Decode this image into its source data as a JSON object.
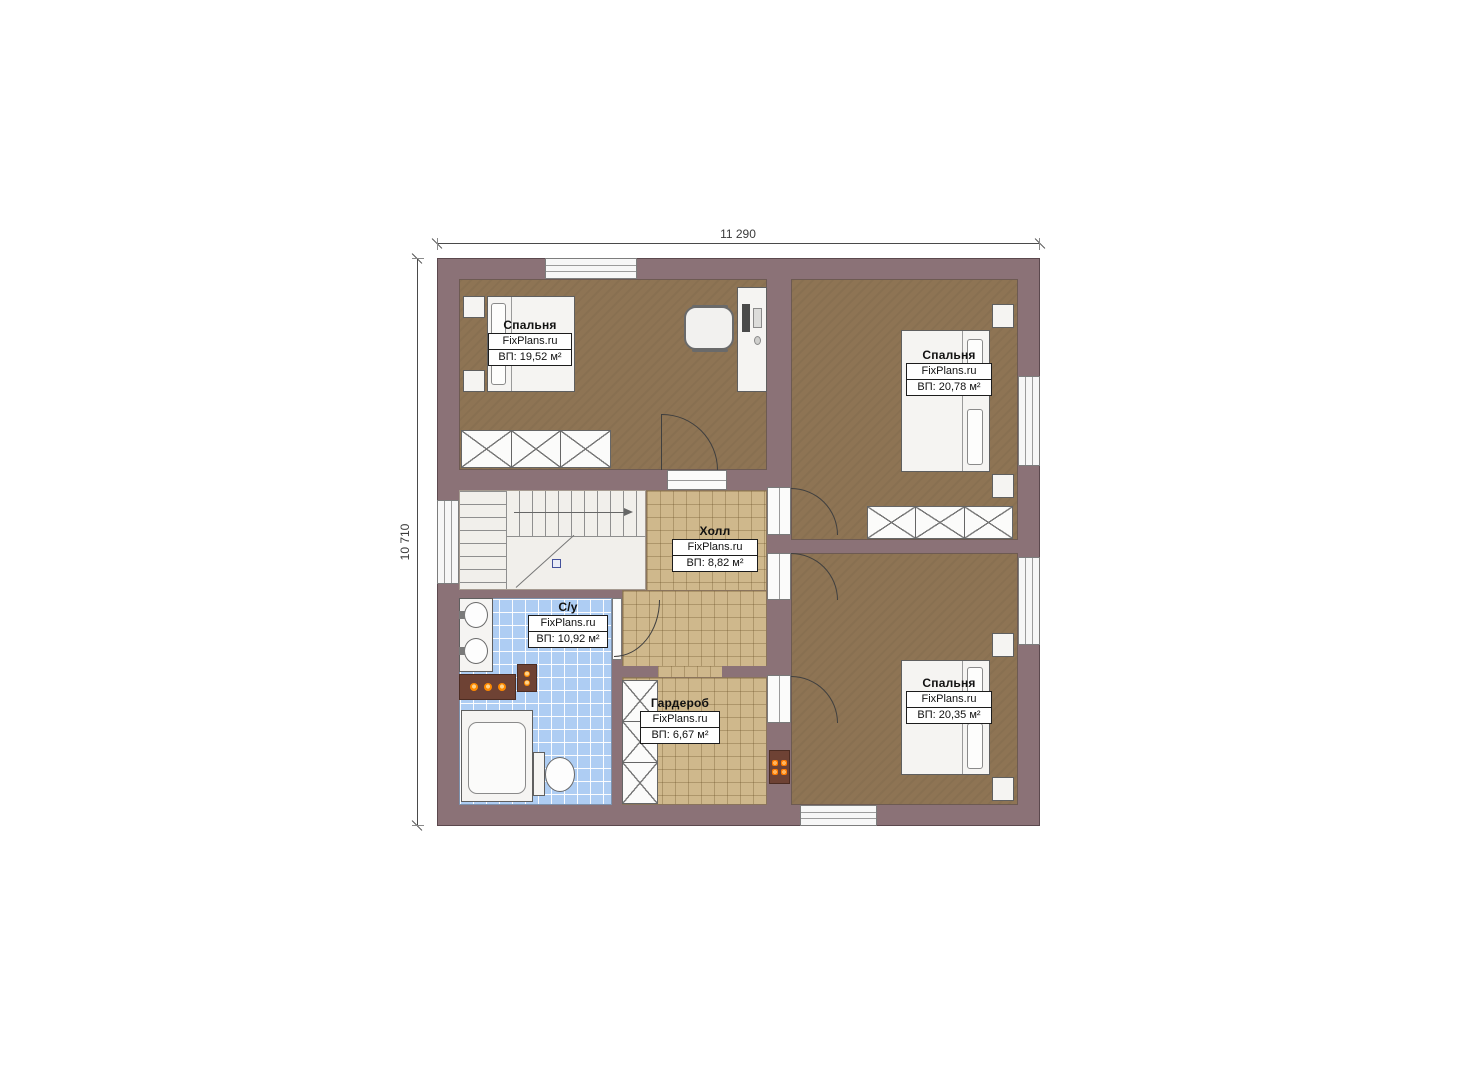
{
  "plan": {
    "type": "floor-plan",
    "language": "ru",
    "brand": "FixPlans.ru"
  },
  "dimensions": {
    "width": "11 290",
    "height": "10 710"
  },
  "rooms": [
    {
      "id": "bedroom-top-left",
      "name": "Спальня",
      "brand": "FixPlans.ru",
      "area": "ВП: 19,52 м²"
    },
    {
      "id": "bedroom-top-right",
      "name": "Спальня",
      "brand": "FixPlans.ru",
      "area": "ВП: 20,78 м²"
    },
    {
      "id": "hall",
      "name": "Холл",
      "brand": "FixPlans.ru",
      "area": "ВП: 8,82 м²"
    },
    {
      "id": "bathroom",
      "name": "С/у",
      "brand": "FixPlans.ru",
      "area": "ВП: 10,92 м²"
    },
    {
      "id": "wardrobe",
      "name": "Гардероб",
      "brand": "FixPlans.ru",
      "area": "ВП: 6,67 м²"
    },
    {
      "id": "bedroom-bottom-right",
      "name": "Спальня",
      "brand": "FixPlans.ru",
      "area": "ВП: 20,35 м²"
    }
  ],
  "colors": {
    "wall": "#8b7277",
    "bedroom_floor": "#8e7454",
    "hall_floor": "#cfb88c",
    "tile_floor": "#aecdf3",
    "flame_accent": "#ff8a00"
  }
}
